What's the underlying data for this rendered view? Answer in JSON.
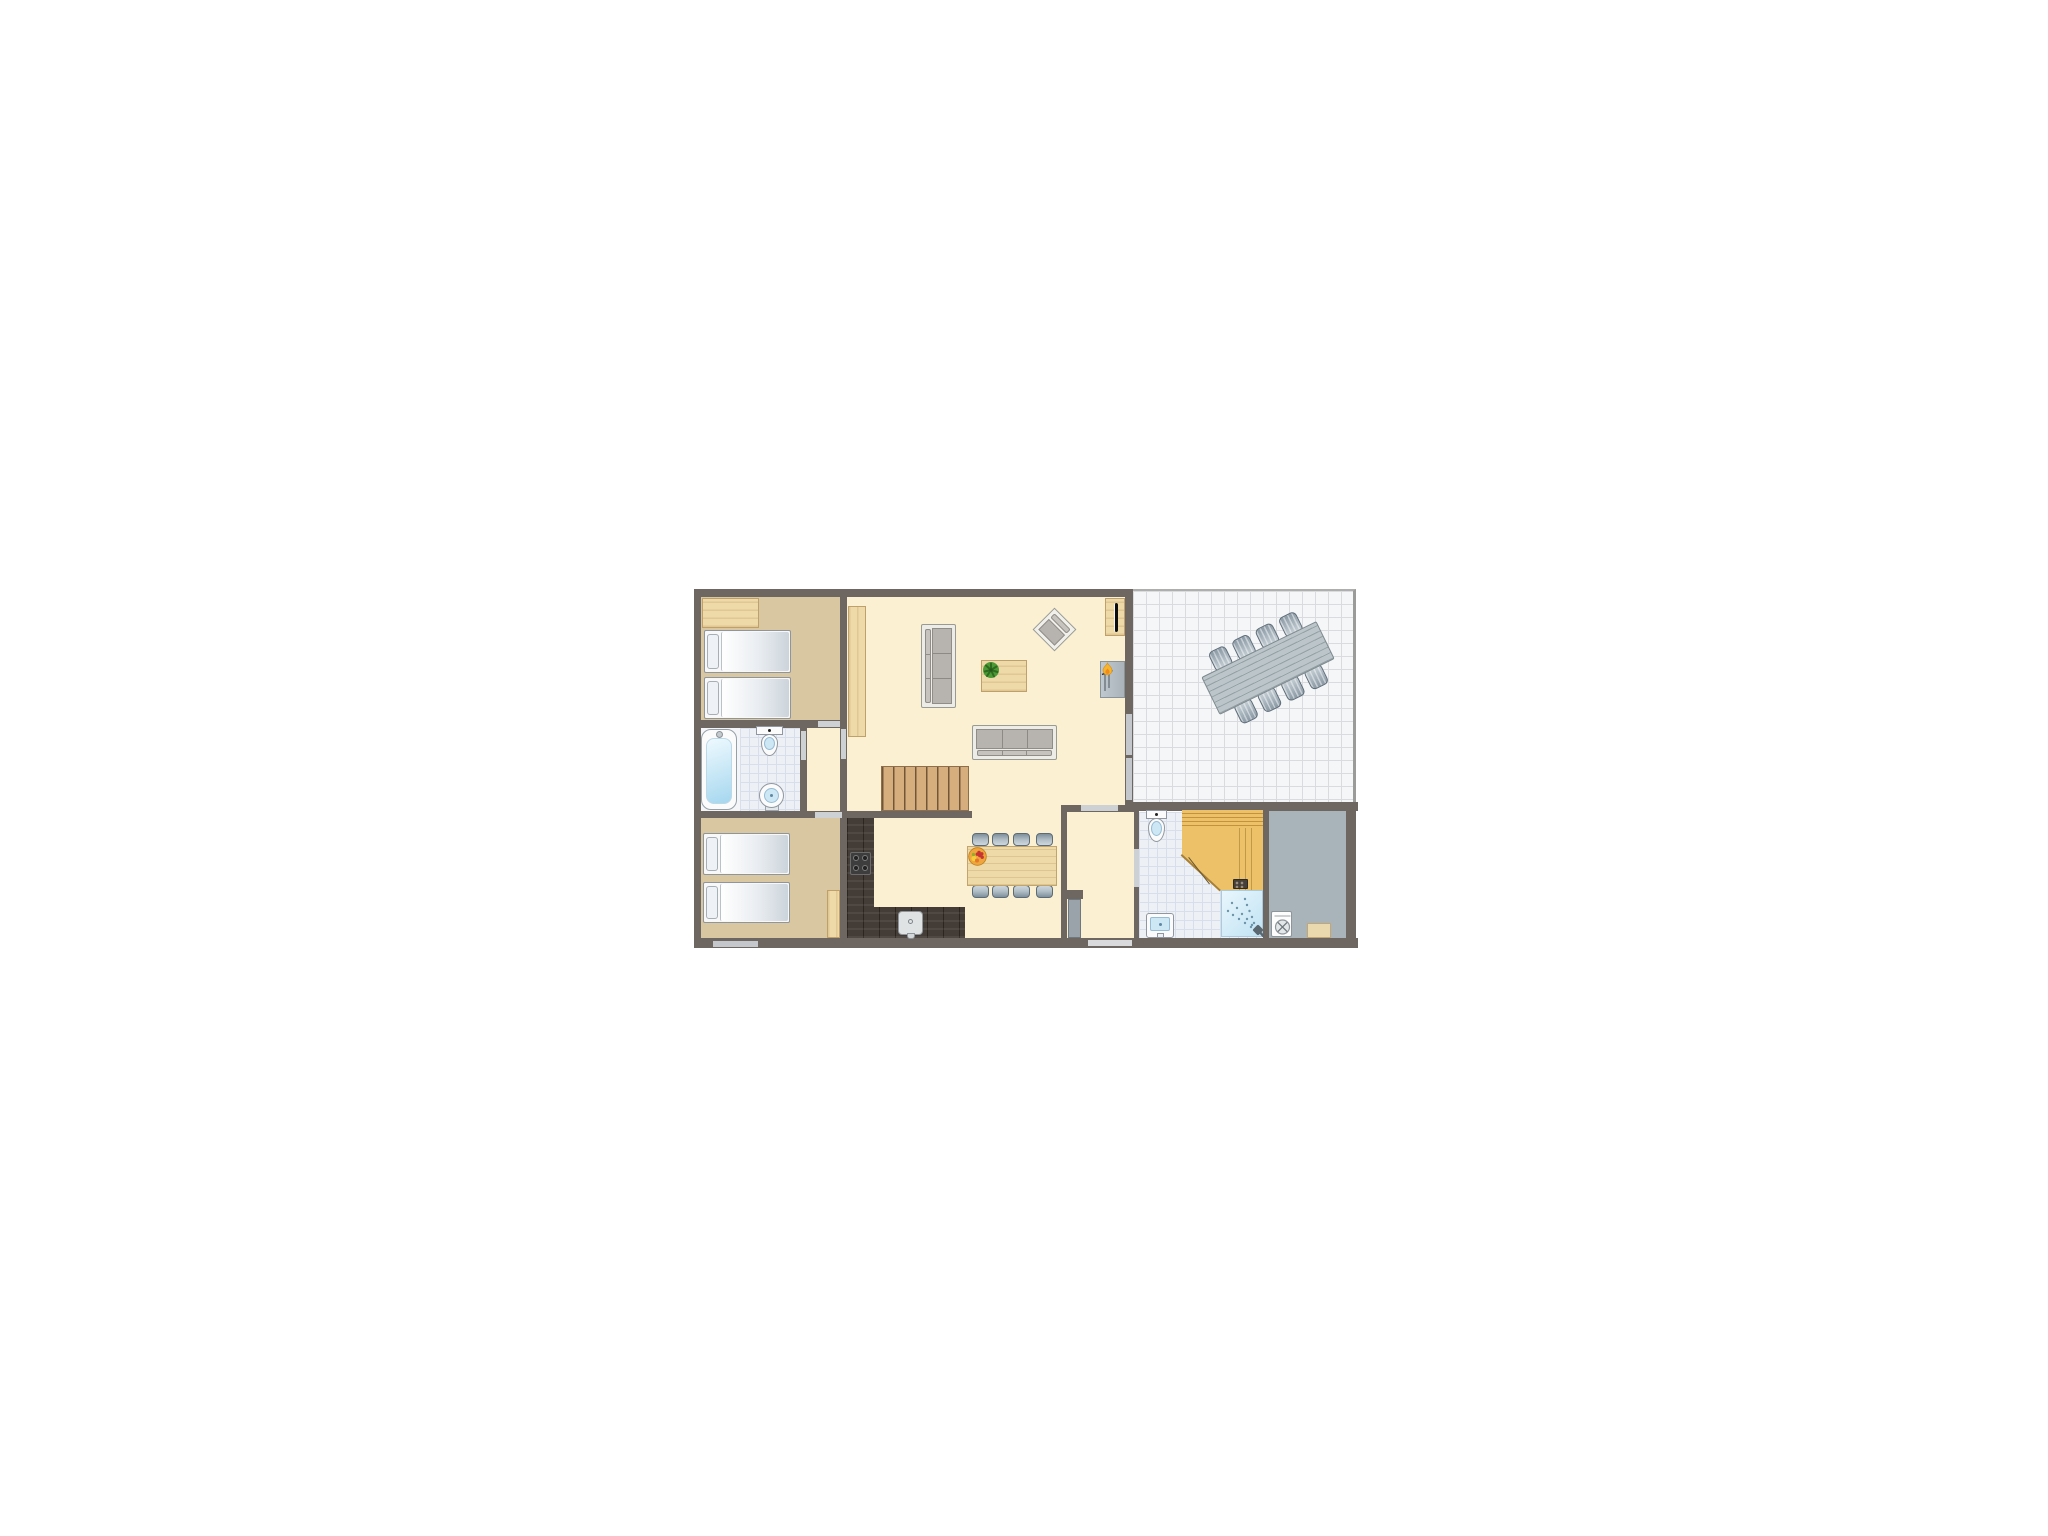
{
  "page": {
    "type": "floor-plan",
    "background": "#ffffff"
  },
  "palette": {
    "wall": "#6e6660",
    "floor_cream": "#fbf1d2",
    "floor_tan": "#d8c7a0",
    "floor_gray": "#a9b3ba",
    "floor_dark": "#443d37",
    "tile": "#edf1f6",
    "terrace_tile": "#f5f6f8",
    "wood": "#eed9a8",
    "wood_border": "#bfa06a",
    "stairs_wood": "#d6ae7e",
    "sauna_wood": "#ecc167",
    "sofa_frame": "#edece6",
    "cushion": "#b7b3af",
    "chair_dark": "#7f909c",
    "chair_light": "#cdd6db",
    "terrace_table": "#bcc6ca",
    "water": "#cde7f5",
    "fixture_white": "#fbfbfb",
    "fixture_border": "#9097a0",
    "door_opening": "#cdd1d4",
    "window_opening": "#c4c8cc",
    "door_leaf": "#9aa3aa",
    "flame": "#f6b52d",
    "flame_core": "#ef8b1e",
    "plant": "#4c9a35",
    "fruit_bowl": "#efa63c",
    "berry": "#c63434",
    "shower_blue": "#bfe2f3"
  },
  "floorplan": {
    "canvas": {
      "w": 1024,
      "h": 768
    },
    "rooms": [
      {
        "id": "bedroom-1",
        "floor": "tan",
        "rect": [
          189,
          211,
          139,
          125
        ]
      },
      {
        "id": "bathroom-1",
        "floor": "tile",
        "rect": [
          189,
          344,
          99,
          83
        ],
        "tileFrom": 39
      },
      {
        "id": "hall",
        "floor": "cream",
        "rect": [
          295,
          344,
          33,
          83
        ]
      },
      {
        "id": "bedroom-2",
        "floor": "tan",
        "rect": [
          189,
          434,
          139,
          120
        ]
      },
      {
        "id": "living-room",
        "floor": "cream",
        "rect": [
          335,
          211,
          278,
          343
        ]
      },
      {
        "id": "kitchen-counter-strip",
        "floor": "dark",
        "rect": [
          335,
          434,
          27,
          120
        ]
      },
      {
        "id": "kitchen-bottom-strip",
        "floor": "dark",
        "rect": [
          335,
          523,
          118,
          31
        ]
      },
      {
        "id": "hallway",
        "floor": "cream",
        "rect": [
          555,
          428,
          67,
          126
        ]
      },
      {
        "id": "bathroom-2",
        "floor": "tile",
        "rect": [
          627,
          428,
          124,
          126
        ]
      },
      {
        "id": "storage-room",
        "floor": "gray",
        "rect": [
          757,
          426,
          77,
          128
        ]
      },
      {
        "id": "terrace",
        "floor": "terrace",
        "rect": [
          621,
          205,
          223,
          213
        ]
      }
    ],
    "walls": [
      [
        182,
        205,
        439,
        8
      ],
      [
        182,
        205,
        7,
        359
      ],
      [
        182,
        554,
        664,
        10
      ],
      [
        613,
        206,
        8,
        213
      ],
      [
        613,
        418,
        233,
        9
      ],
      [
        549,
        421,
        6,
        138
      ],
      [
        834,
        421,
        10,
        143
      ],
      [
        328,
        205,
        7,
        139
      ],
      [
        189,
        336,
        139,
        8
      ],
      [
        288,
        344,
        7,
        83
      ],
      [
        328,
        344,
        7,
        84
      ],
      [
        189,
        427,
        146,
        7
      ],
      [
        328,
        434,
        7,
        120
      ],
      [
        335,
        427,
        125,
        7
      ],
      [
        622,
        428,
        5,
        127
      ],
      [
        751,
        426,
        6,
        128
      ],
      [
        549,
        506,
        22,
        9
      ],
      [
        549,
        421,
        78,
        7
      ]
    ],
    "openings": [
      {
        "kind": "door",
        "name": "door-bedroom-1",
        "rect": [
          306,
          337,
          22,
          6
        ]
      },
      {
        "kind": "door",
        "name": "door-hall-living",
        "rect": [
          329,
          345,
          5,
          30
        ]
      },
      {
        "kind": "door",
        "name": "door-bathroom-1",
        "rect": [
          289,
          347,
          5,
          29
        ]
      },
      {
        "kind": "door",
        "name": "door-bedroom-2",
        "rect": [
          303,
          428,
          27,
          6
        ]
      },
      {
        "kind": "door",
        "name": "doorway-hallway",
        "rect": [
          569,
          421,
          37,
          6
        ]
      },
      {
        "kind": "threshold",
        "name": "entrance-door",
        "rect": [
          576,
          556,
          44,
          6
        ]
      },
      {
        "kind": "door",
        "name": "door-bathroom-2",
        "rect": [
          622,
          465,
          5,
          38
        ]
      },
      {
        "kind": "window",
        "name": "window-living-terrace-1",
        "rect": [
          614,
          330,
          6,
          41
        ]
      },
      {
        "kind": "window",
        "name": "window-living-terrace-2",
        "rect": [
          614,
          374,
          6,
          42
        ]
      },
      {
        "kind": "window",
        "name": "window-bedroom-2",
        "rect": [
          201,
          557,
          45,
          6
        ]
      }
    ],
    "furniture": [
      {
        "type": "wardrobe",
        "name": "wardrobe",
        "rect": [
          190,
          214,
          57,
          30
        ],
        "grain": "h"
      },
      {
        "type": "bed",
        "name": "bed-1",
        "rect": [
          192,
          246,
          87,
          43
        ]
      },
      {
        "type": "bed",
        "name": "bed-2",
        "rect": [
          192,
          293,
          87,
          42
        ]
      },
      {
        "type": "bathtub",
        "name": "bathtub",
        "rect": [
          189,
          345,
          36,
          81
        ]
      },
      {
        "type": "toilet",
        "name": "toilet-1",
        "rect": [
          244,
          342,
          27,
          34
        ]
      },
      {
        "type": "washbasin-round",
        "name": "washbasin-1",
        "rect": [
          246,
          399,
          28,
          28
        ]
      },
      {
        "type": "bed",
        "name": "bed-3",
        "rect": [
          191,
          449,
          87,
          42
        ]
      },
      {
        "type": "bed",
        "name": "bed-4",
        "rect": [
          191,
          498,
          87,
          41
        ]
      },
      {
        "type": "closet",
        "name": "closet",
        "rect": [
          315,
          506,
          13,
          48
        ],
        "grain": "v"
      },
      {
        "type": "cabinet",
        "name": "tall-cabinet",
        "rect": [
          336,
          222,
          18,
          131
        ],
        "grain": "v"
      },
      {
        "type": "sofa",
        "name": "sofa-1",
        "rect": [
          409,
          240,
          35,
          84
        ],
        "orient": "v"
      },
      {
        "type": "coffee-table",
        "name": "coffee-table",
        "rect": [
          469,
          276,
          46,
          32
        ]
      },
      {
        "type": "armchair",
        "name": "armchair",
        "rect": [
          527,
          230,
          31,
          31
        ],
        "rot": 45
      },
      {
        "type": "sofa",
        "name": "sofa-2",
        "rect": [
          460,
          341,
          85,
          35
        ],
        "orient": "h"
      },
      {
        "type": "tv-cabinet",
        "name": "tv-cabinet",
        "rect": [
          593,
          214,
          20,
          38
        ]
      },
      {
        "type": "fireplace",
        "name": "fireplace",
        "rect": [
          588,
          277,
          25,
          37
        ]
      },
      {
        "type": "stairs",
        "name": "stairs",
        "rect": [
          369,
          382,
          88,
          45
        ]
      },
      {
        "type": "cooktop",
        "name": "cooktop",
        "rect": [
          338,
          468,
          21,
          23
        ]
      },
      {
        "type": "kitchen-sink",
        "name": "kitchen-sink",
        "rect": [
          386,
          527,
          25,
          24
        ]
      },
      {
        "type": "dining-set",
        "name": "dining-set",
        "rect": [
          448,
          449,
          104,
          66
        ]
      },
      {
        "type": "door-leaf",
        "name": "interior-door-leaf",
        "rect": [
          556,
          515,
          13,
          39
        ]
      },
      {
        "type": "toilet",
        "name": "toilet-2",
        "rect": [
          634,
          426,
          21,
          36
        ]
      },
      {
        "type": "washbasin-square",
        "name": "washbasin-2",
        "rect": [
          634,
          529,
          28,
          25
        ]
      },
      {
        "type": "sauna",
        "name": "sauna",
        "rect": [
          670,
          426,
          81,
          80
        ]
      },
      {
        "type": "shower",
        "name": "shower",
        "rect": [
          709,
          506,
          42,
          47
        ]
      },
      {
        "type": "washing-machine",
        "name": "washing-machine",
        "rect": [
          759,
          527,
          21,
          26
        ]
      },
      {
        "type": "doormat",
        "name": "doormat",
        "rect": [
          795,
          539,
          24,
          15
        ]
      },
      {
        "type": "terrace-set",
        "name": "terrace-dining-set",
        "rect": [
          681,
          229,
          150,
          110
        ],
        "rot": -26
      }
    ]
  }
}
